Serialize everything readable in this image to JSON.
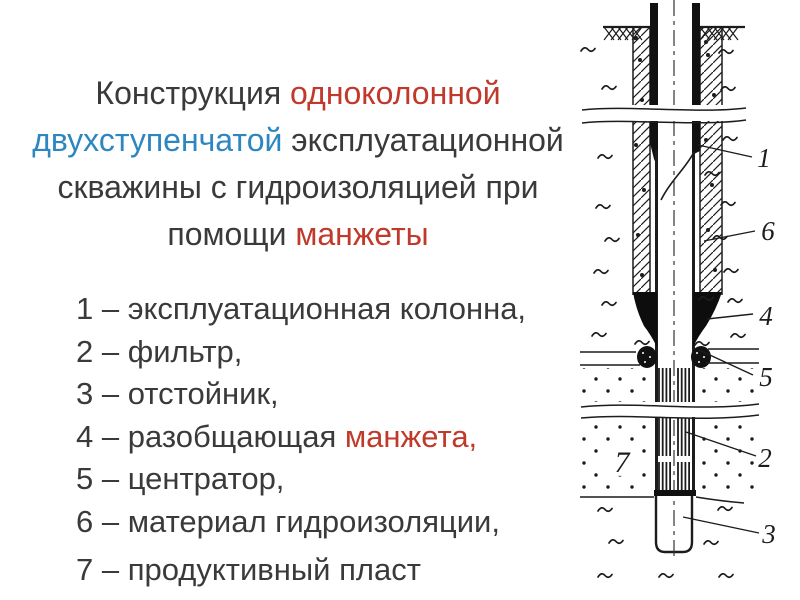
{
  "colors": {
    "text": "#3a3a3a",
    "red": "#c0392b",
    "blue": "#2e86c1",
    "line": "#1c1c1c"
  },
  "title": {
    "lines": [
      [
        {
          "t": "Конструкция ",
          "c": "text"
        },
        {
          "t": "одноколонной",
          "c": "red"
        }
      ],
      [
        {
          "t": "двухступенчатой",
          "c": "blue"
        },
        {
          "t": " эксплуатационной",
          "c": "text"
        }
      ],
      [
        {
          "t": "скважины с гидроизоляцией при",
          "c": "text"
        }
      ],
      [
        {
          "t": "помощи ",
          "c": "text"
        },
        {
          "t": "манжеты",
          "c": "red"
        }
      ]
    ]
  },
  "legend": {
    "items": [
      {
        "segments": [
          {
            "t": "1 – эксплуатационная колонна,",
            "c": "text"
          }
        ]
      },
      {
        "segments": [
          {
            "t": "2 – фильтр,",
            "c": "text"
          }
        ]
      },
      {
        "segments": [
          {
            "t": "3 – отстойник,",
            "c": "text"
          }
        ]
      },
      {
        "segments": [
          {
            "t": "4 – разобщающая ",
            "c": "text"
          },
          {
            "t": "манжета,",
            "c": "red"
          }
        ]
      },
      {
        "segments": [
          {
            "t": "5 – центратор,",
            "c": "text"
          }
        ]
      },
      {
        "segments": [
          {
            "t": "6 – материал гидроизоляции,",
            "c": "text"
          }
        ]
      },
      {
        "segments": [
          {
            "t": "7 – продуктивный пласт",
            "c": "text"
          }
        ]
      }
    ]
  },
  "diagram": {
    "callouts": {
      "c1": "1",
      "c2": "2",
      "c3": "3",
      "c4": "4",
      "c5": "5",
      "c6": "6",
      "c7": "7"
    }
  }
}
